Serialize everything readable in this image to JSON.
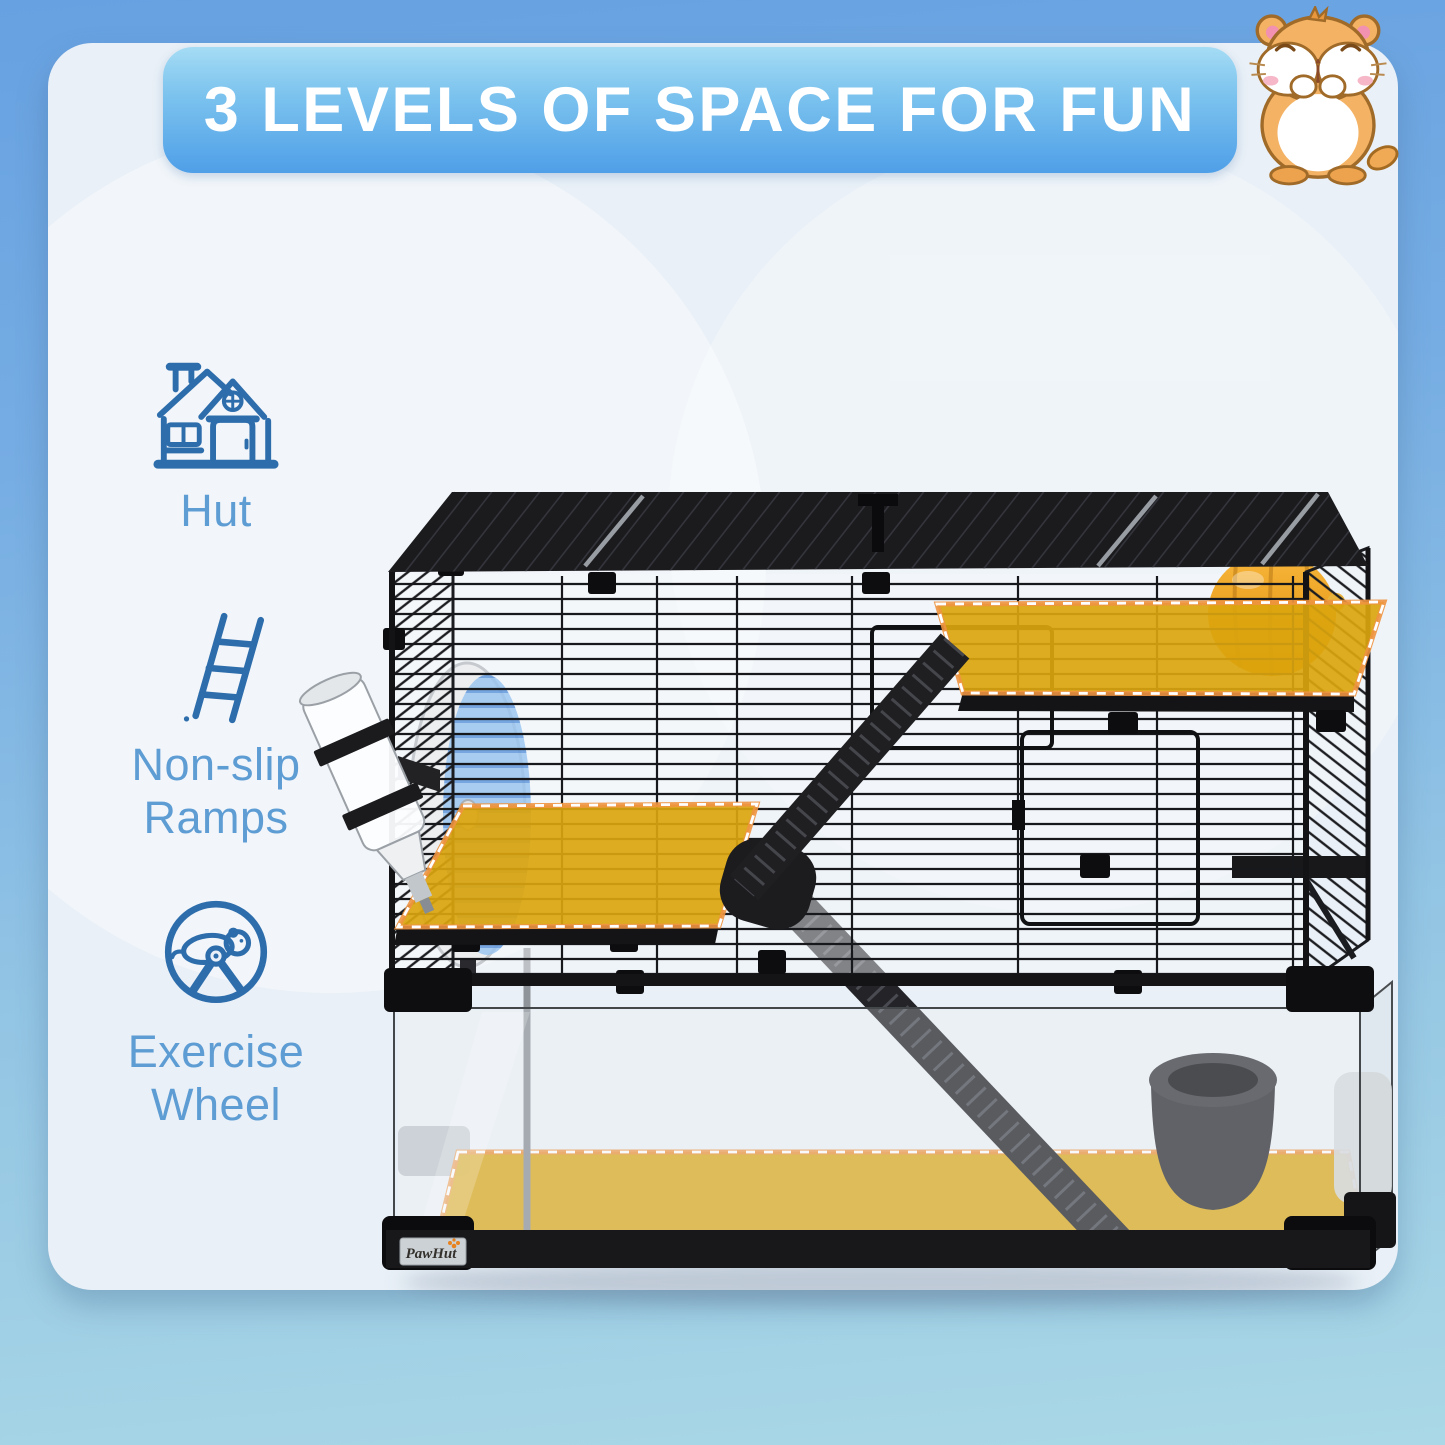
{
  "theme": {
    "page_bg_top": "#67a1e1",
    "page_bg_bottom": "#aad8e6",
    "card_bg": "#e9f0f7",
    "banner_gradient_top": "#a5dcf4",
    "banner_gradient_bottom": "#4f9fe8",
    "banner_text_color": "#ffffff",
    "feature_icon_stroke": "#2e6dac",
    "feature_label_color": "#5e9cd4",
    "highlight_yellow": "#dba50e",
    "highlight_dash_orange": "#ee9440",
    "highlight_dash_white": "#ffffff",
    "cage_black": "#1b1b1e"
  },
  "banner": {
    "title": "3 LEVELS OF SPACE FOR FUN"
  },
  "features": [
    {
      "id": "hut",
      "icon": "hut-icon",
      "lines": [
        "Hut"
      ]
    },
    {
      "id": "non-slip-ramps",
      "icon": "ladder-icon",
      "lines": [
        "Non-slip",
        "Ramps"
      ]
    },
    {
      "id": "exercise-wheel",
      "icon": "exercise-wheel-icon",
      "lines": [
        "Exercise",
        "Wheel"
      ]
    }
  ],
  "brand": {
    "logo_text": "PawHut"
  },
  "mascot": {
    "name": "hamster-illustration"
  },
  "product_photo": {
    "levels": "3",
    "items": [
      "cage-roof",
      "wire-cage",
      "water-bottle",
      "exercise-wheel",
      "hut",
      "top-platform",
      "middle-platform",
      "upper-ramp",
      "lower-ramp",
      "glass-tank",
      "tank-floor",
      "food-bowl",
      "brand-logo"
    ]
  }
}
